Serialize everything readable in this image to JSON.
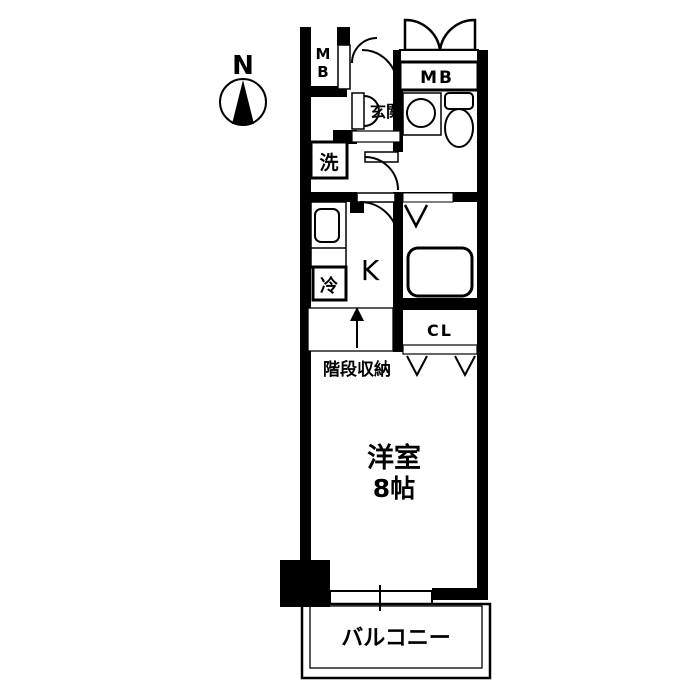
{
  "plan": {
    "title": "apartment-floor-plan",
    "compass": {
      "label": "N"
    },
    "labels": {
      "mb_left_line1": "M",
      "mb_left_line2": "B",
      "mb_right": "MB",
      "entrance": "玄関",
      "washer": "洗",
      "fridge": "冷",
      "kitchen": "K",
      "stair_storage": "階段収納",
      "closet": "CL",
      "room_name": "洋室",
      "room_size": "8帖",
      "balcony": "バルコニー"
    },
    "colors": {
      "wall": "#000000",
      "background": "#ffffff",
      "line": "#000000"
    }
  }
}
